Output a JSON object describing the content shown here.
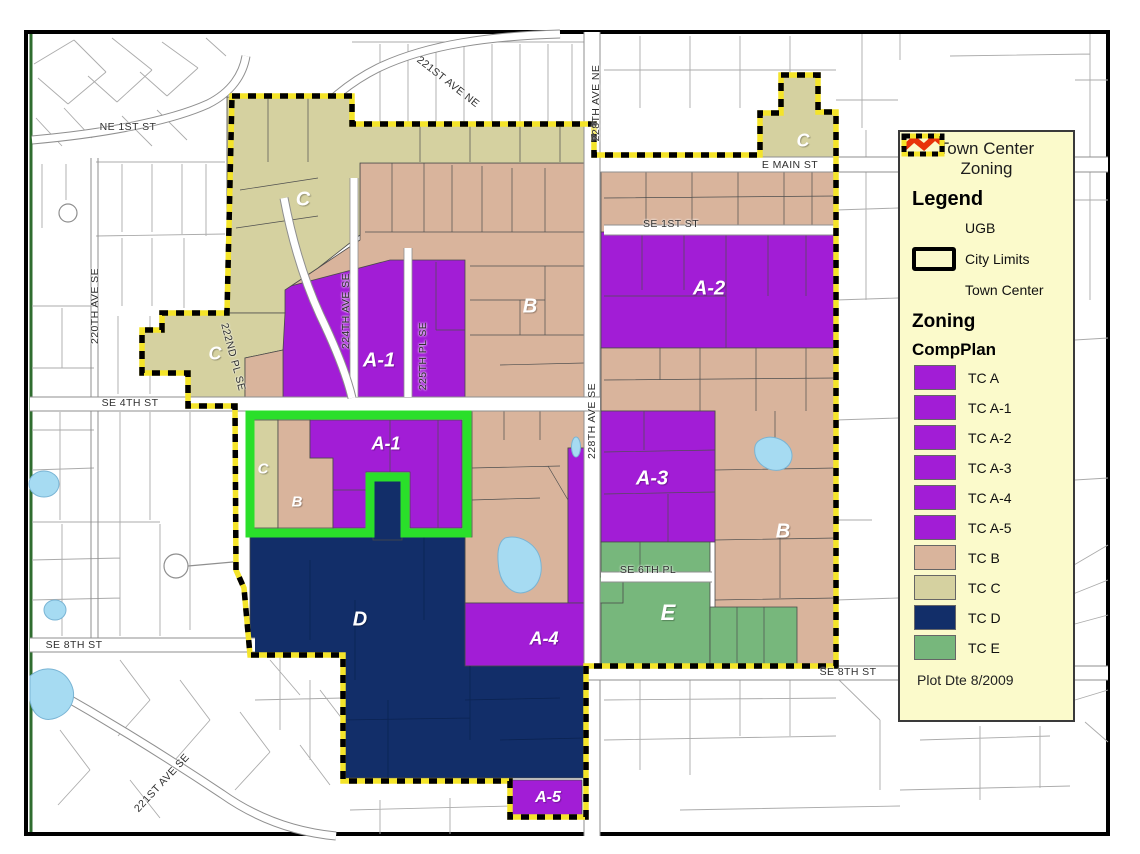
{
  "title": {
    "line1": "Town Center",
    "line2": "Zoning"
  },
  "legend": {
    "heading": "Legend",
    "boundaries": [
      {
        "label": "UGB",
        "symbol": "ugb-zigzag",
        "color": "#E8330A"
      },
      {
        "label": "City Limits",
        "symbol": "city-limits-box",
        "color": "#000000"
      },
      {
        "label": "Town Center",
        "symbol": "town-center-dashed",
        "colors": [
          "#F4E42A",
          "#000000"
        ]
      }
    ],
    "zoning_heading": "Zoning",
    "compplan_heading": "CompPlan",
    "compplan": [
      {
        "label": "TC A",
        "color": "#A21DD6"
      },
      {
        "label": "TC A-1",
        "color": "#A21DD6"
      },
      {
        "label": "TC A-2",
        "color": "#A21DD6"
      },
      {
        "label": "TC A-3",
        "color": "#A21DD6"
      },
      {
        "label": "TC A-4",
        "color": "#A21DD6"
      },
      {
        "label": "TC A-5",
        "color": "#A21DD6"
      },
      {
        "label": "TC B",
        "color": "#D9B49C"
      },
      {
        "label": "TC C",
        "color": "#D5D1A0"
      },
      {
        "label": "TC D",
        "color": "#122E69"
      },
      {
        "label": "TC E",
        "color": "#77B77C"
      }
    ],
    "plot_date": "Plot Dte 8/2009"
  },
  "map_colors": {
    "water": "#A6DBF2",
    "city_limits_green": "#2ADF2A",
    "town_center_yellow": "#F4E42A",
    "ugb_red": "#E8330A",
    "road": "#FFFFFF"
  },
  "streets": [
    {
      "name": "221ST AVE NE",
      "cx": 448,
      "cy": 82,
      "rot": 38
    },
    {
      "name": "NE 1ST ST",
      "cx": 128,
      "cy": 127,
      "rot": 0
    },
    {
      "name": "228TH AVE NE",
      "cx": 596,
      "cy": 103,
      "rot": -90
    },
    {
      "name": "E MAIN ST",
      "cx": 790,
      "cy": 165,
      "rot": 0
    },
    {
      "name": "SE 1ST ST",
      "cx": 671,
      "cy": 224,
      "rot": 0
    },
    {
      "name": "220TH AVE SE",
      "cx": 95,
      "cy": 306,
      "rot": -90
    },
    {
      "name": "222ND PL SE",
      "cx": 233,
      "cy": 357,
      "rot": 75
    },
    {
      "name": "224TH AVE SE",
      "cx": 346,
      "cy": 311,
      "rot": -90
    },
    {
      "name": "225TH PL SE",
      "cx": 423,
      "cy": 356,
      "rot": -90
    },
    {
      "name": "SE 4TH ST",
      "cx": 130,
      "cy": 403,
      "rot": 0
    },
    {
      "name": "228TH AVE SE",
      "cx": 592,
      "cy": 421,
      "rot": -90
    },
    {
      "name": "SE 6TH PL",
      "cx": 648,
      "cy": 570,
      "rot": 0
    },
    {
      "name": "SE 8TH ST",
      "cx": 74,
      "cy": 645,
      "rot": 0
    },
    {
      "name": "SE 8TH ST",
      "cx": 848,
      "cy": 672,
      "rot": 0
    },
    {
      "name": "221ST AVE SE",
      "cx": 162,
      "cy": 783,
      "rot": -47
    }
  ],
  "zone_labels": [
    {
      "text": "C",
      "cx": 303,
      "cy": 200,
      "size": 20
    },
    {
      "text": "C",
      "cx": 215,
      "cy": 354,
      "size": 18
    },
    {
      "text": "C",
      "cx": 803,
      "cy": 141,
      "size": 18
    },
    {
      "text": "C",
      "cx": 263,
      "cy": 469,
      "size": 15
    },
    {
      "text": "A-1",
      "cx": 379,
      "cy": 361,
      "size": 20
    },
    {
      "text": "A-1",
      "cx": 386,
      "cy": 444,
      "size": 18
    },
    {
      "text": "A-2",
      "cx": 709,
      "cy": 289,
      "size": 20
    },
    {
      "text": "A-3",
      "cx": 652,
      "cy": 479,
      "size": 20
    },
    {
      "text": "A-4",
      "cx": 544,
      "cy": 639,
      "size": 18
    },
    {
      "text": "A-5",
      "cx": 548,
      "cy": 798,
      "size": 16
    },
    {
      "text": "B",
      "cx": 530,
      "cy": 307,
      "size": 20
    },
    {
      "text": "B",
      "cx": 297,
      "cy": 502,
      "size": 15
    },
    {
      "text": "B",
      "cx": 783,
      "cy": 532,
      "size": 20
    },
    {
      "text": "D",
      "cx": 360,
      "cy": 620,
      "size": 20
    },
    {
      "text": "E",
      "cx": 668,
      "cy": 613,
      "size": 22
    }
  ]
}
